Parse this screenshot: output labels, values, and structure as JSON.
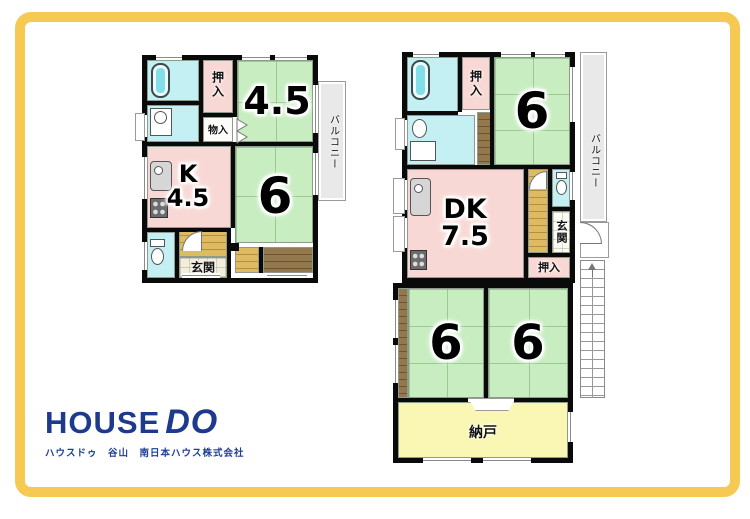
{
  "colors": {
    "frame_yellow": "#f6ca52",
    "logo_navy": "#1d3a8f",
    "tatami_green": "#c7edc0",
    "room_pink": "#f8d8d4",
    "wet_cyan": "#c4f0f4",
    "hall_tan": "#deba62",
    "wood_brown": "#93784e",
    "nando_yellow": "#f9f7b3",
    "balcony_gray": "#e9e9e9",
    "wall_black": "#0a0a0a"
  },
  "left_plan": {
    "labels": {
      "oshiire": "押入",
      "monoire": "物入",
      "room_45": "4.5",
      "kitchen": "K",
      "kitchen_size": "4.5",
      "room_6": "6",
      "balcony": "バルコニー",
      "genkan": "玄関"
    }
  },
  "right_plan": {
    "labels": {
      "oshiire_top": "押入",
      "room_6_top": "6",
      "balcony": "バルコニー",
      "dk": "DK",
      "dk_size": "7.5",
      "genkan": "玄関",
      "oshiire_mid": "押入",
      "room_6_left": "6",
      "room_6_right": "6",
      "nando": "納戸"
    }
  },
  "logo": {
    "brand_house": "HOUSE",
    "brand_do": "DO",
    "subtitle": "ハウスドゥ　谷山　南日本ハウス株式会社"
  }
}
